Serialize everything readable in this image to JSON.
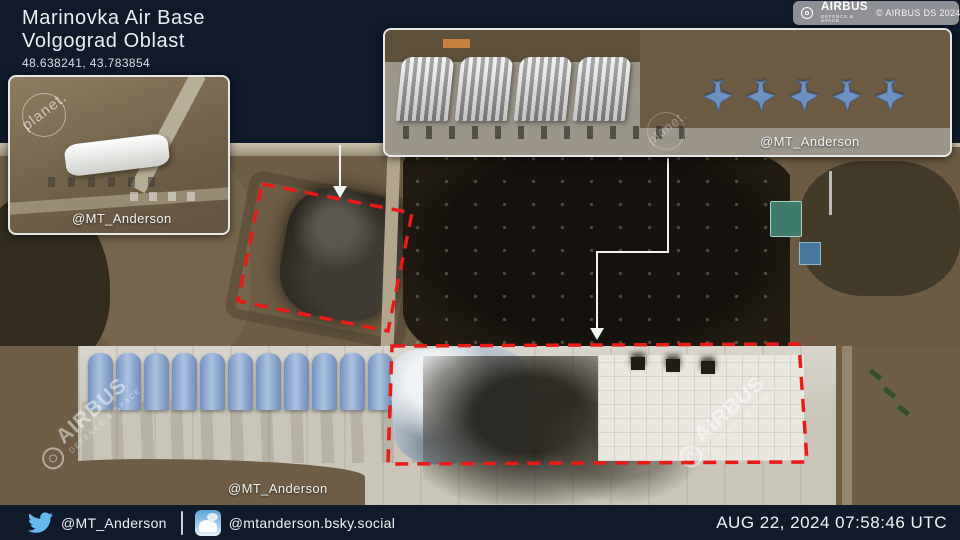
{
  "header": {
    "title_line1": "Marinovka Air Base",
    "title_line2": "Volgograd Oblast",
    "coordinates": "48.638241, 43.783854"
  },
  "airbus": {
    "brand": "AIRBUS",
    "division": "DEFENCE & SPACE",
    "copyright": "© AIRBUS DS 2024",
    "badge_bg": "#8f9095"
  },
  "planet_watermark": "planet.",
  "insets": [
    {
      "credit": "@MT_Anderson"
    },
    {
      "credit": "@MT_Anderson",
      "hangar_count": 4,
      "jet_count": 5
    }
  ],
  "main_image": {
    "credit": "@MT_Anderson",
    "shelter_count": 11,
    "annotation_color": "#e81b17",
    "leader_color": "#f2f2f2"
  },
  "footer": {
    "twitter_handle": "@MT_Anderson",
    "bluesky_handle": "@mtanderson.bsky.social",
    "timestamp": "AUG 22, 2024 07:58:46 UTC"
  }
}
